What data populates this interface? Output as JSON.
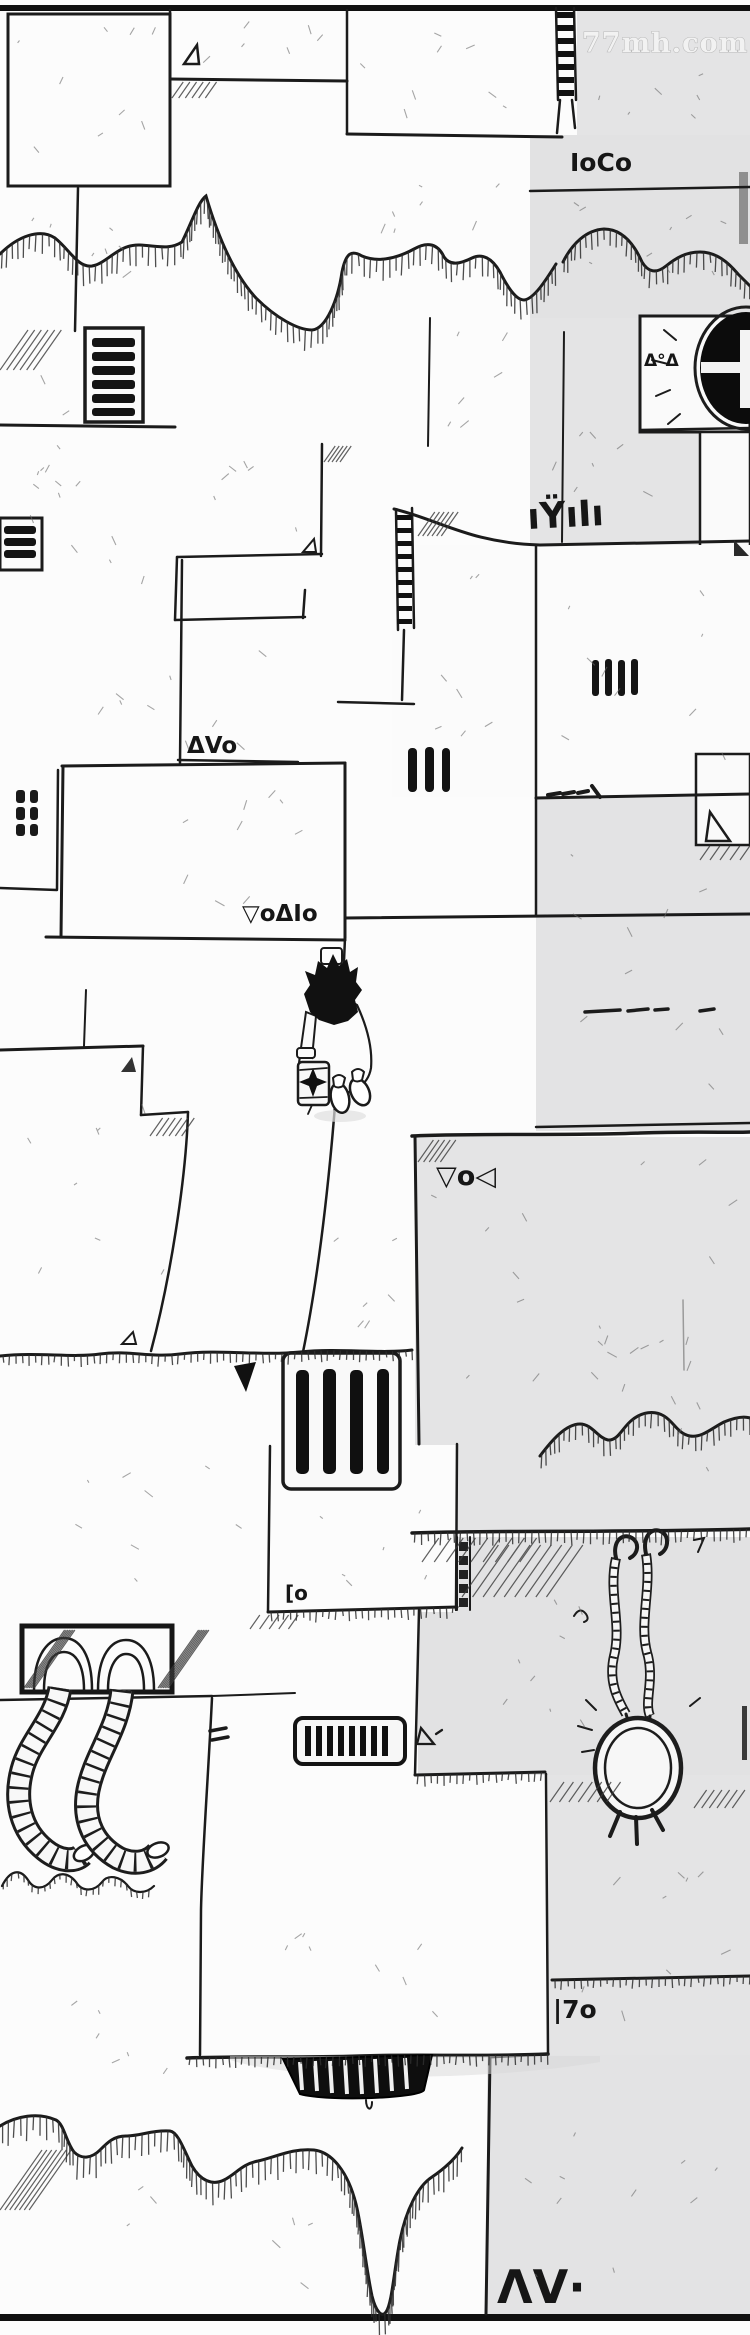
{
  "watermark": {
    "text": "77mh.com"
  },
  "scene": {
    "type": "comic-panel",
    "style": "black-and-white hand-drawn manhua, top-down view of stone wall patchwork",
    "elements": [
      "stone wall panels",
      "gray wall panels",
      "dripping melted edges",
      "ventilation grilles",
      "ladders",
      "round porthole grate",
      "walking character with lantern",
      "corrugated wall hoses from socket",
      "hanging segmented-cable ring",
      "alien wall glyphs"
    ]
  },
  "glyphs": {
    "vent_code_top": "IoCo",
    "porthole_code": "Δ°Δ",
    "wall_code_mid": "ıŸıIı",
    "step_code": "ΔVo",
    "floor_code_long": "▽oΔIo",
    "gray_panel_code": "▽o◁",
    "small_bracket_code": "[o",
    "lower_right_code": "|7o",
    "bottom_code": "ΛV·"
  },
  "palette": {
    "paper": "#fcfcfc",
    "gray_panel": "#e4e4e5",
    "ink": "#1b1b1b",
    "sketch": "#6a6a6a"
  }
}
